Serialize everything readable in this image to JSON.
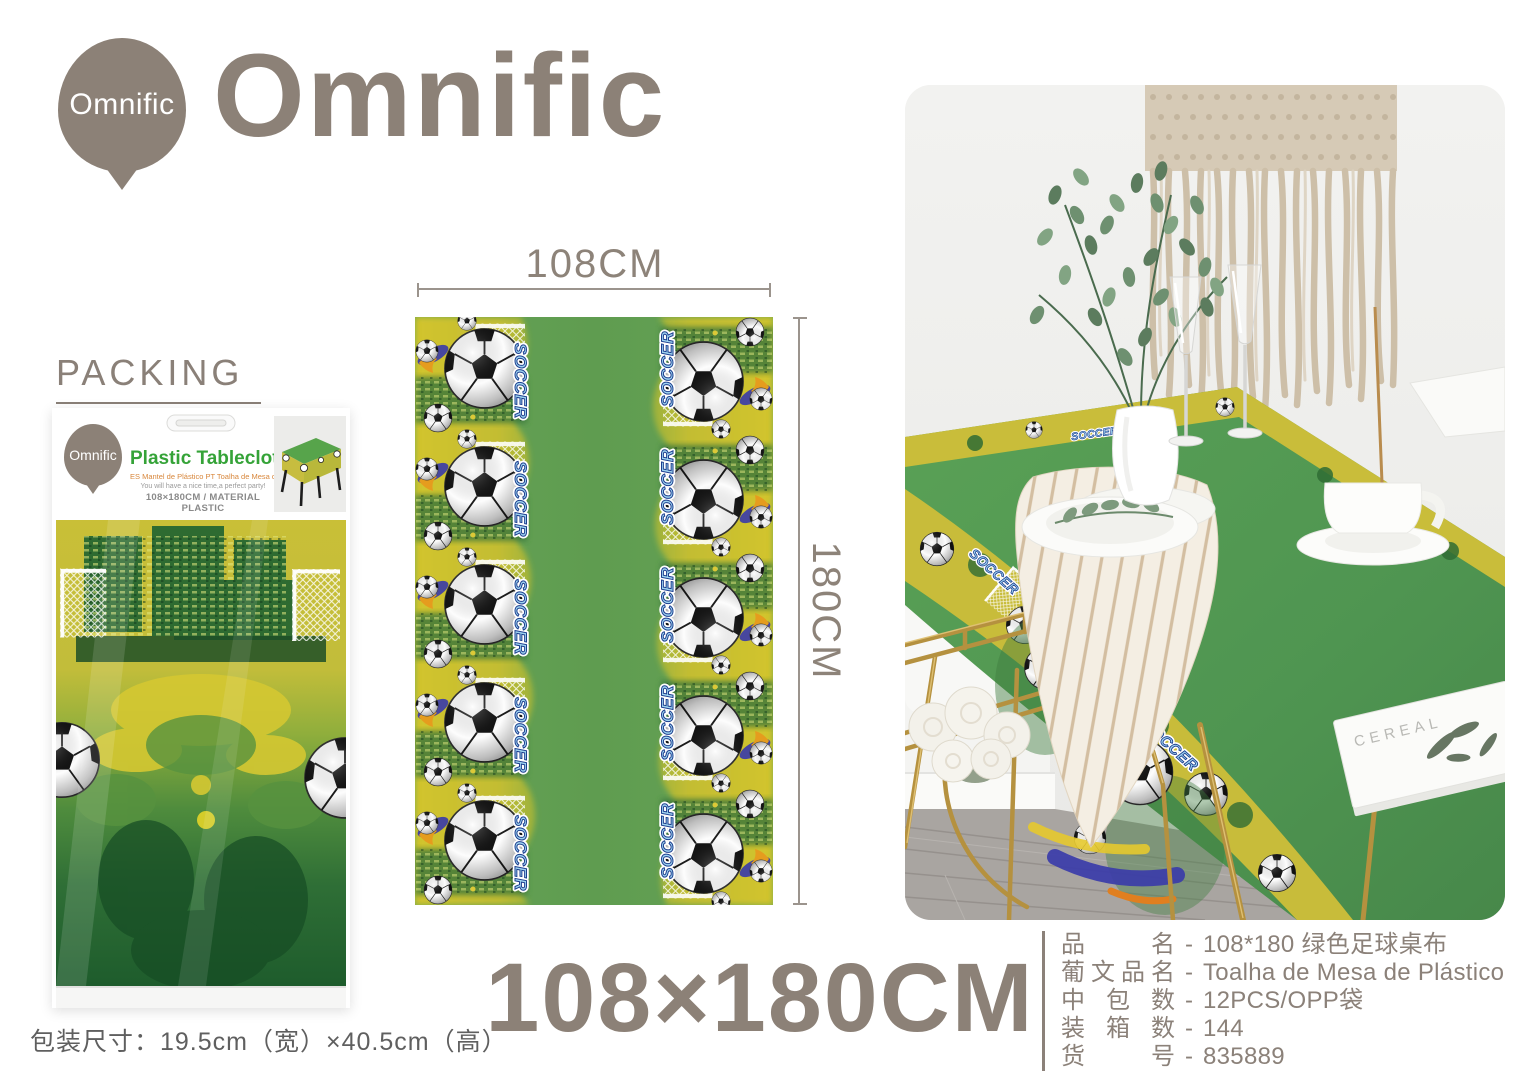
{
  "brand": {
    "logo_text": "Omnific",
    "wordmark": "Omnific"
  },
  "packing": {
    "title": "PACKING",
    "package": {
      "brand": "Omnific",
      "product_title": "Plastic Tablecloth",
      "subtitle_es_pt": "ES Mantel de Plástico  PT Toalha de Mesa de Plástico",
      "tagline": "You will have a nice time,a perfect party!",
      "spec_line": "108×180CM / MATERIAL PLASTIC"
    },
    "package_size_note": "包装尺寸：19.5cm（宽）×40.5cm（高）"
  },
  "diagram": {
    "width_label": "108CM",
    "height_label": "180CM",
    "pattern_text": "SOCCER"
  },
  "size_callout": "108×180CM",
  "photo": {
    "book_title": "CEREAL"
  },
  "specs": {
    "separator": "-",
    "rows": [
      {
        "label": "品名",
        "value": "108*180 绿色足球桌布"
      },
      {
        "label": "葡文品名",
        "value": "Toalha de Mesa de Plástico"
      },
      {
        "label": "中包数",
        "value": "12PCS/OPP袋"
      },
      {
        "label": "装箱数",
        "value": "144"
      },
      {
        "label": "货号",
        "value": "835889"
      }
    ]
  },
  "colors": {
    "accent_taupe": "#8C8177",
    "tablecloth_green": "#579A4F",
    "border_yellow": "#C9BD3A",
    "package_title_green": "#35A338",
    "soccer_text_blue": "#1D3E8F",
    "gold_chair": "#B5913F"
  }
}
